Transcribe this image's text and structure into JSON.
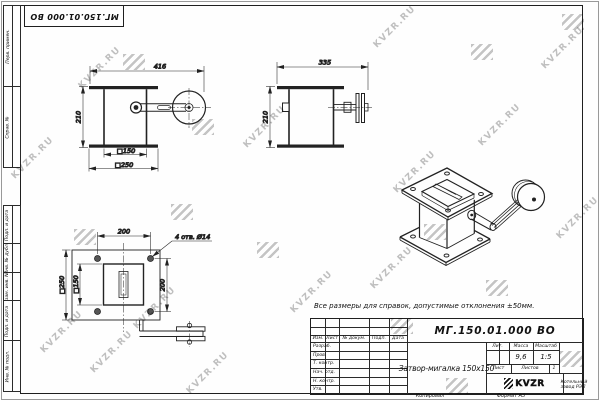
{
  "watermark": {
    "text": "KVZR.RU"
  },
  "corner_stamp": {
    "designation": "МГ.150.01.000 ВО"
  },
  "side_stamps": {
    "items": [
      "Перв. примен.",
      "Справ. №",
      "Подп. и дата",
      "Инв. № дубл.",
      "Взам. инв. №",
      "Подп. и дата",
      "Инв. № подл."
    ]
  },
  "note": {
    "text": "Все размеры для справок, допустимые отклонения ±50мм."
  },
  "views": {
    "front": {
      "dim_width": "416",
      "dim_height": "210",
      "dim_inner": "□150",
      "dim_outer": "□250"
    },
    "side": {
      "dim_width": "335",
      "dim_height": "210"
    },
    "plan": {
      "dim_top": "200",
      "dim_right": "200",
      "dim_inner": "□150",
      "dim_outer": "□250",
      "holes_note": "4 отв. Ø14"
    }
  },
  "title_block": {
    "designation": "МГ.150.01.000 ВО",
    "name": "Затвор-мигалка 150х150",
    "header": {
      "izm": "Изм.",
      "list": "Лист",
      "doc": "№ докум.",
      "sign": "Подп.",
      "date": "Дата"
    },
    "rows": [
      "Разраб.",
      "Пров.",
      "Т. контр.",
      "Нач. отд.",
      "Н. контр.",
      "Утв."
    ],
    "lit_label": "Лит.",
    "mass_label": "Масса",
    "scale_label": "Масштаб",
    "mass": "9,6",
    "scale": "1:5",
    "sheet_label": "Лист",
    "sheets_label": "Листов",
    "sheets_value": "1",
    "logo_word": "KVZR",
    "logo_sub": "Котельный завод РЭП",
    "copied": "Копировал",
    "format": "Формат А3"
  }
}
